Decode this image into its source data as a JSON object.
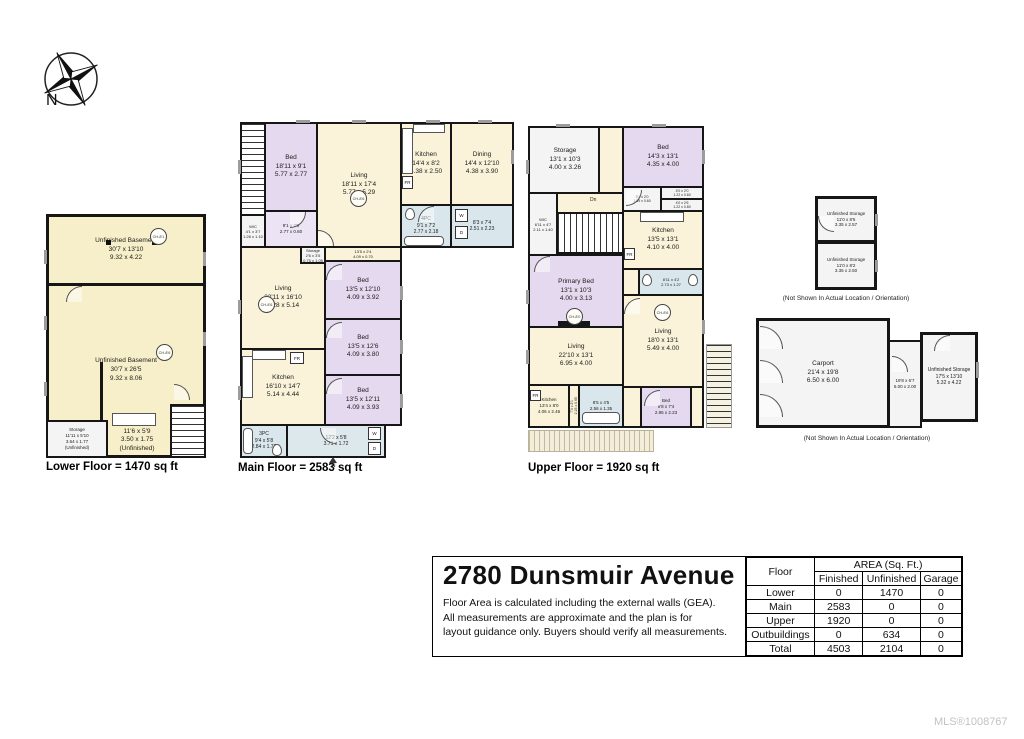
{
  "meta": {
    "mls": "MLS®1008767"
  },
  "palette": {
    "wall": "#161616",
    "room_cream": "#faf3d9",
    "room_purple": "#e4d9ee",
    "room_blue": "#d9e7ec",
    "room_white": "#f4f4f4",
    "window_gray": "#9c9c9c"
  },
  "compass": {
    "label": "N"
  },
  "captions": {
    "lower": "Lower Floor = 1470 sq ft",
    "main": "Main Floor = 2583 sq ft",
    "upper": "Upper Floor = 1920 sq ft",
    "outbuilding_note": "(Not Shown In Actual Location / Orientation)"
  },
  "labels": {
    "washer": "W",
    "dryer": "D",
    "fridge": "FR",
    "stairs_down": "Dn",
    "entry": "IN"
  },
  "title_block": {
    "title": "2780 Dunsmuir Avenue",
    "disclaimer_lines": [
      "Floor Area is calculated including the external walls (GEA).",
      "All measurements are approximate and the plan is for",
      "layout guidance only. Buyers should verify all measurements."
    ]
  },
  "area_table": {
    "col_floor": "Floor",
    "col_group": "AREA (Sq. Ft.)",
    "cols": [
      "Finished",
      "Unfinished",
      "Garage"
    ],
    "rows": [
      {
        "floor": "Lower",
        "finished": "0",
        "unfinished": "1470",
        "garage": "0"
      },
      {
        "floor": "Main",
        "finished": "2583",
        "unfinished": "0",
        "garage": "0"
      },
      {
        "floor": "Upper",
        "finished": "1920",
        "unfinished": "0",
        "garage": "0"
      },
      {
        "floor": "Outbuildings",
        "finished": "0",
        "unfinished": "634",
        "garage": "0"
      },
      {
        "floor": "Total",
        "finished": "4503",
        "unfinished": "2104",
        "garage": "0"
      }
    ]
  },
  "floors": {
    "lower": {
      "rooms": [
        {
          "name": "Unfinished Basement",
          "ft": "30'7 x 13'10",
          "m": "9.32 x 4.22",
          "ch": "CH-8'1"
        },
        {
          "name": "Unfinished Basement",
          "ft": "30'7 x 26'5",
          "m": "9.32 x 8.06",
          "ch": "CH-8'6"
        },
        {
          "name": "Storage",
          "ft": "11'11 x 5'10",
          "m": "3.64 x 1.77",
          "note": "(Unfinished)"
        },
        {
          "name": "",
          "ft": "11'6 x 5'9",
          "m": "3.50 x 1.75",
          "note": "(Unfinished)"
        }
      ]
    },
    "main": {
      "rooms": [
        {
          "name": "WIC",
          "ft": "4'1 x 3'7",
          "m": "1.26 x 1.10"
        },
        {
          "name": "Bed",
          "ft": "18'11 x 9'1",
          "m": "5.77 x 2.77"
        },
        {
          "name": "",
          "ft": "9'1 x 2'0",
          "m": "2.77 x 0.60"
        },
        {
          "name": "Living",
          "ft": "18'11 x 17'4",
          "m": "5.77 x 5.29",
          "ch": "CH-8'6"
        },
        {
          "name": "Kitchen",
          "ft": "14'4 x 8'2",
          "m": "4.38 x 2.50"
        },
        {
          "name": "Dining",
          "ft": "14'4 x 12'10",
          "m": "4.38 x 3.90"
        },
        {
          "name": "4PC",
          "ft": "9'1 x 7'2",
          "m": "2.77 x 2.18"
        },
        {
          "name": "",
          "ft": "8'3 x 7'4",
          "m": "2.51 x 2.23"
        },
        {
          "name": "Storage",
          "ft": "2'6 x 3'5",
          "m": "0.75 x 1.05"
        },
        {
          "name": "",
          "ft": "13'5 x 2'4",
          "m": "4.09 x 0.70"
        },
        {
          "name": "Bed",
          "ft": "13'5 x 12'10",
          "m": "4.09 x 3.92"
        },
        {
          "name": "Bed",
          "ft": "13'5 x 12'6",
          "m": "4.09 x 3.80"
        },
        {
          "name": "Bed",
          "ft": "13'5 x 12'11",
          "m": "4.09 x 3.93"
        },
        {
          "name": "Living",
          "ft": "23'11 x 16'10",
          "m": "7.28 x 5.14",
          "ch": "CH-8'6"
        },
        {
          "name": "Kitchen",
          "ft": "16'10 x 14'7",
          "m": "5.14 x 4.44"
        },
        {
          "name": "3PC",
          "ft": "9'4 x 5'8",
          "m": "2.84 x 1.72"
        },
        {
          "name": "",
          "ft": "12'2 x 5'8",
          "m": "3.71 x 1.72"
        }
      ]
    },
    "upper": {
      "rooms": [
        {
          "name": "Storage",
          "ft": "13'1 x 10'3",
          "m": "4.00 x 3.26"
        },
        {
          "name": "WIC",
          "ft": "6'11 x 4'7",
          "m": "2.11 x 1.40"
        },
        {
          "name": "Primary Bed",
          "ft": "13'1 x 10'3",
          "m": "4.00 x 3.13",
          "ch": "CH-8'0"
        },
        {
          "name": "Living",
          "ft": "22'10 x 13'1",
          "m": "6.95 x 4.00"
        },
        {
          "name": "Kitchen",
          "ft": "13'4 x 8'0",
          "m": "4.06 x 2.46"
        },
        {
          "name": "",
          "ft": "8'5 x 4'5",
          "m": "2.56 x 1.35"
        },
        {
          "name": "",
          "ft": "7'4 x 2'1",
          "m": "2.23 x 0.65"
        },
        {
          "name": "Bed",
          "ft": "14'3 x 13'1",
          "m": "4.35 x 4.00"
        },
        {
          "name": "",
          "ft": "5'3 x 2'0",
          "m": "1.59 x 0.60"
        },
        {
          "name": "",
          "ft": "4'0 x 2'0",
          "m": "1.22 x 0.60"
        },
        {
          "name": "",
          "ft": "4'0 x 2'6",
          "m": "1.22 x 0.80"
        },
        {
          "name": "Kitchen",
          "ft": "13'5 x 13'1",
          "m": "4.10 x 4.00"
        },
        {
          "name": "",
          "ft": "8'11 x 4'2",
          "m": "2.73 x 1.27"
        },
        {
          "name": "Living",
          "ft": "18'0 x 13'1",
          "m": "5.49 x 4.00",
          "ch": "CH-8'6"
        },
        {
          "name": "Bed",
          "ft": "9'8 x 7'4",
          "m": "2.95 x 2.23"
        }
      ]
    }
  },
  "outbuildings": {
    "shed": {
      "rooms": [
        {
          "name": "Unfinished Storage",
          "ft": "11'0 x 8'5",
          "m": "3.35 x 2.57"
        },
        {
          "name": "Unfinished Storage",
          "ft": "11'0 x 8'2",
          "m": "3.35 x 2.50"
        }
      ]
    },
    "carport_block": {
      "rooms": [
        {
          "name": "Carport",
          "ft": "21'4 x 19'8",
          "m": "6.50 x 6.00"
        },
        {
          "name": "",
          "ft": "19'8 x 6'7",
          "m": "6.00 x 2.00"
        },
        {
          "name": "Unfinished Storage",
          "ft": "17'5 x 13'10",
          "m": "5.32 x 4.22"
        }
      ]
    }
  }
}
